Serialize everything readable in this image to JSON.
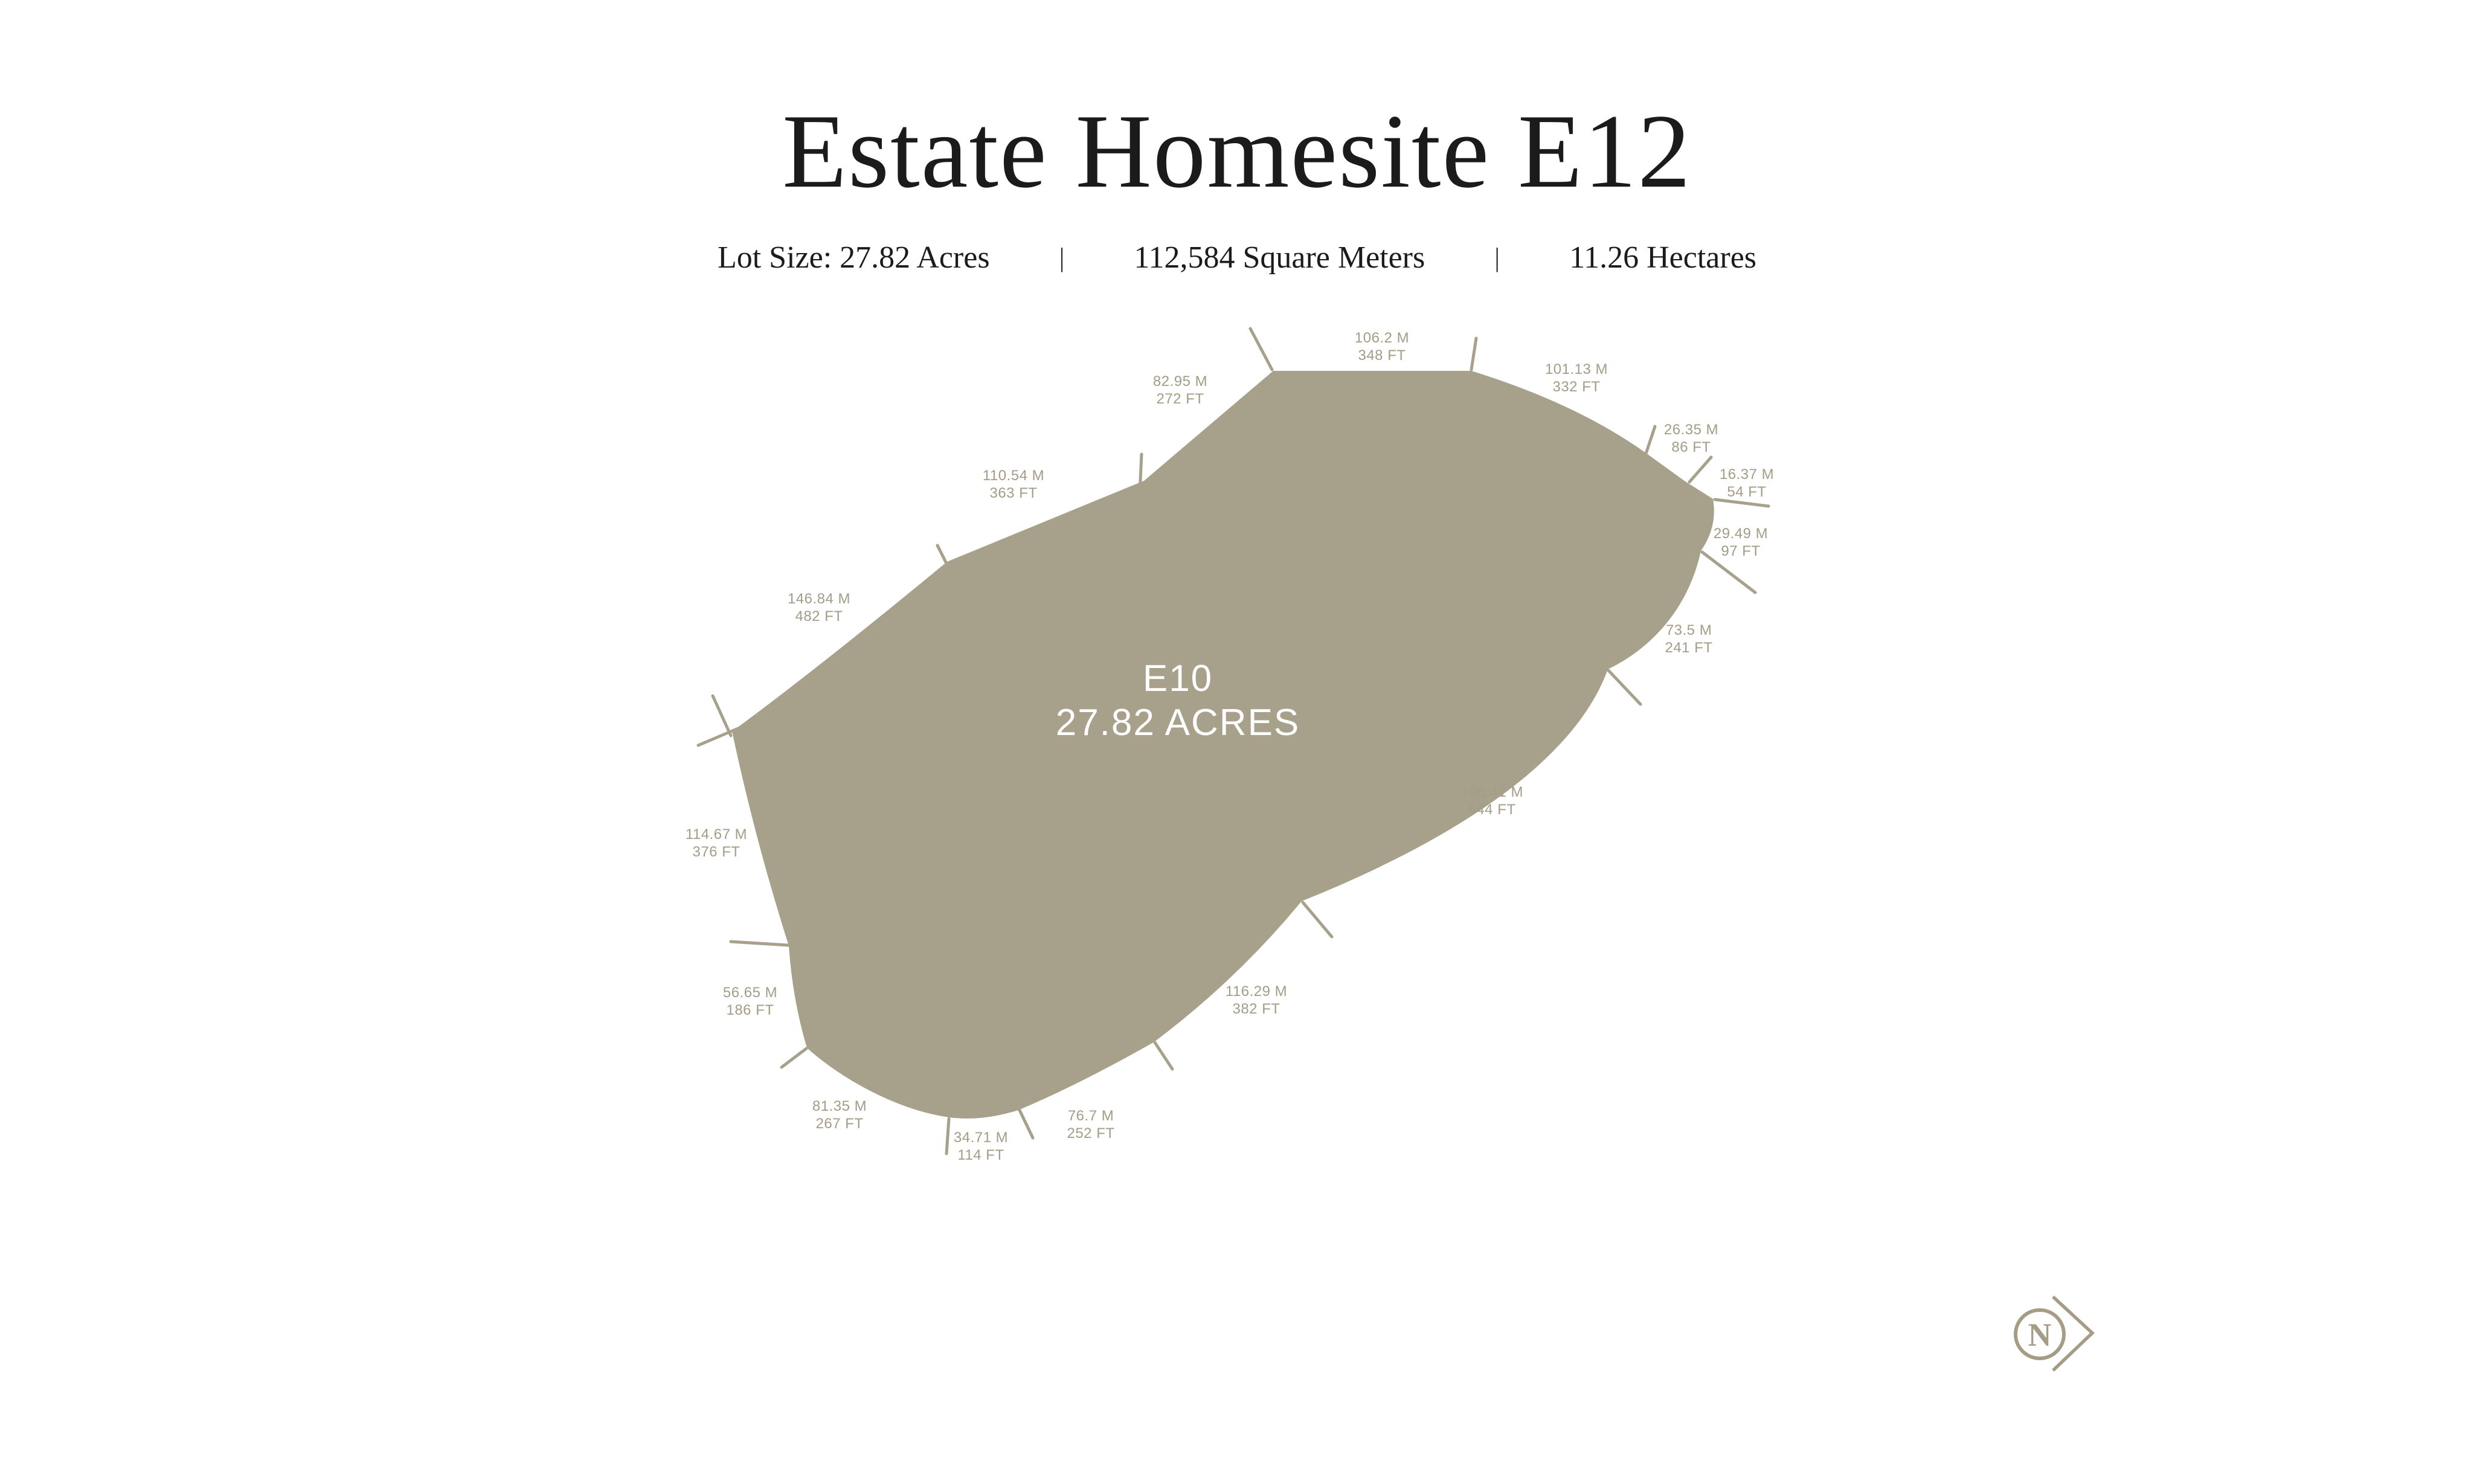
{
  "header": {
    "title": "Estate Homesite E12",
    "lot_size_acres": "Lot Size: 27.82 Acres",
    "divider": "|",
    "square_meters": "112,584 Square Meters",
    "hectares": "11.26 Hectares"
  },
  "parcel": {
    "id": "E10",
    "area": "27.82 ACRES",
    "edges": [
      {
        "m": "106.2 M",
        "ft": "348 FT"
      },
      {
        "m": "101.13 M",
        "ft": "332 FT"
      },
      {
        "m": "26.35 M",
        "ft": "86 FT"
      },
      {
        "m": "16.37 M",
        "ft": "54 FT"
      },
      {
        "m": "29.49 M",
        "ft": "97 FT"
      },
      {
        "m": "73.5 M",
        "ft": "241 FT"
      },
      {
        "m": "196.41 M",
        "ft": "644 FT"
      },
      {
        "m": "116.29 M",
        "ft": "382 FT"
      },
      {
        "m": "76.7 M",
        "ft": "252 FT"
      },
      {
        "m": "34.71 M",
        "ft": "114 FT"
      },
      {
        "m": "81.35 M",
        "ft": "267 FT"
      },
      {
        "m": "56.65 M",
        "ft": "186 FT"
      },
      {
        "m": "114.67 M",
        "ft": "376 FT"
      },
      {
        "m": "146.84 M",
        "ft": "482 FT"
      },
      {
        "m": "110.54 M",
        "ft": "363 FT"
      },
      {
        "m": "82.95 M",
        "ft": "272 FT"
      }
    ]
  },
  "compass": {
    "letter": "N"
  },
  "colors": {
    "background": "#ffffff",
    "parcel_fill": "#a7a08a",
    "dimension_text": "#a49c85",
    "title_ink": "#1b1b1b"
  }
}
